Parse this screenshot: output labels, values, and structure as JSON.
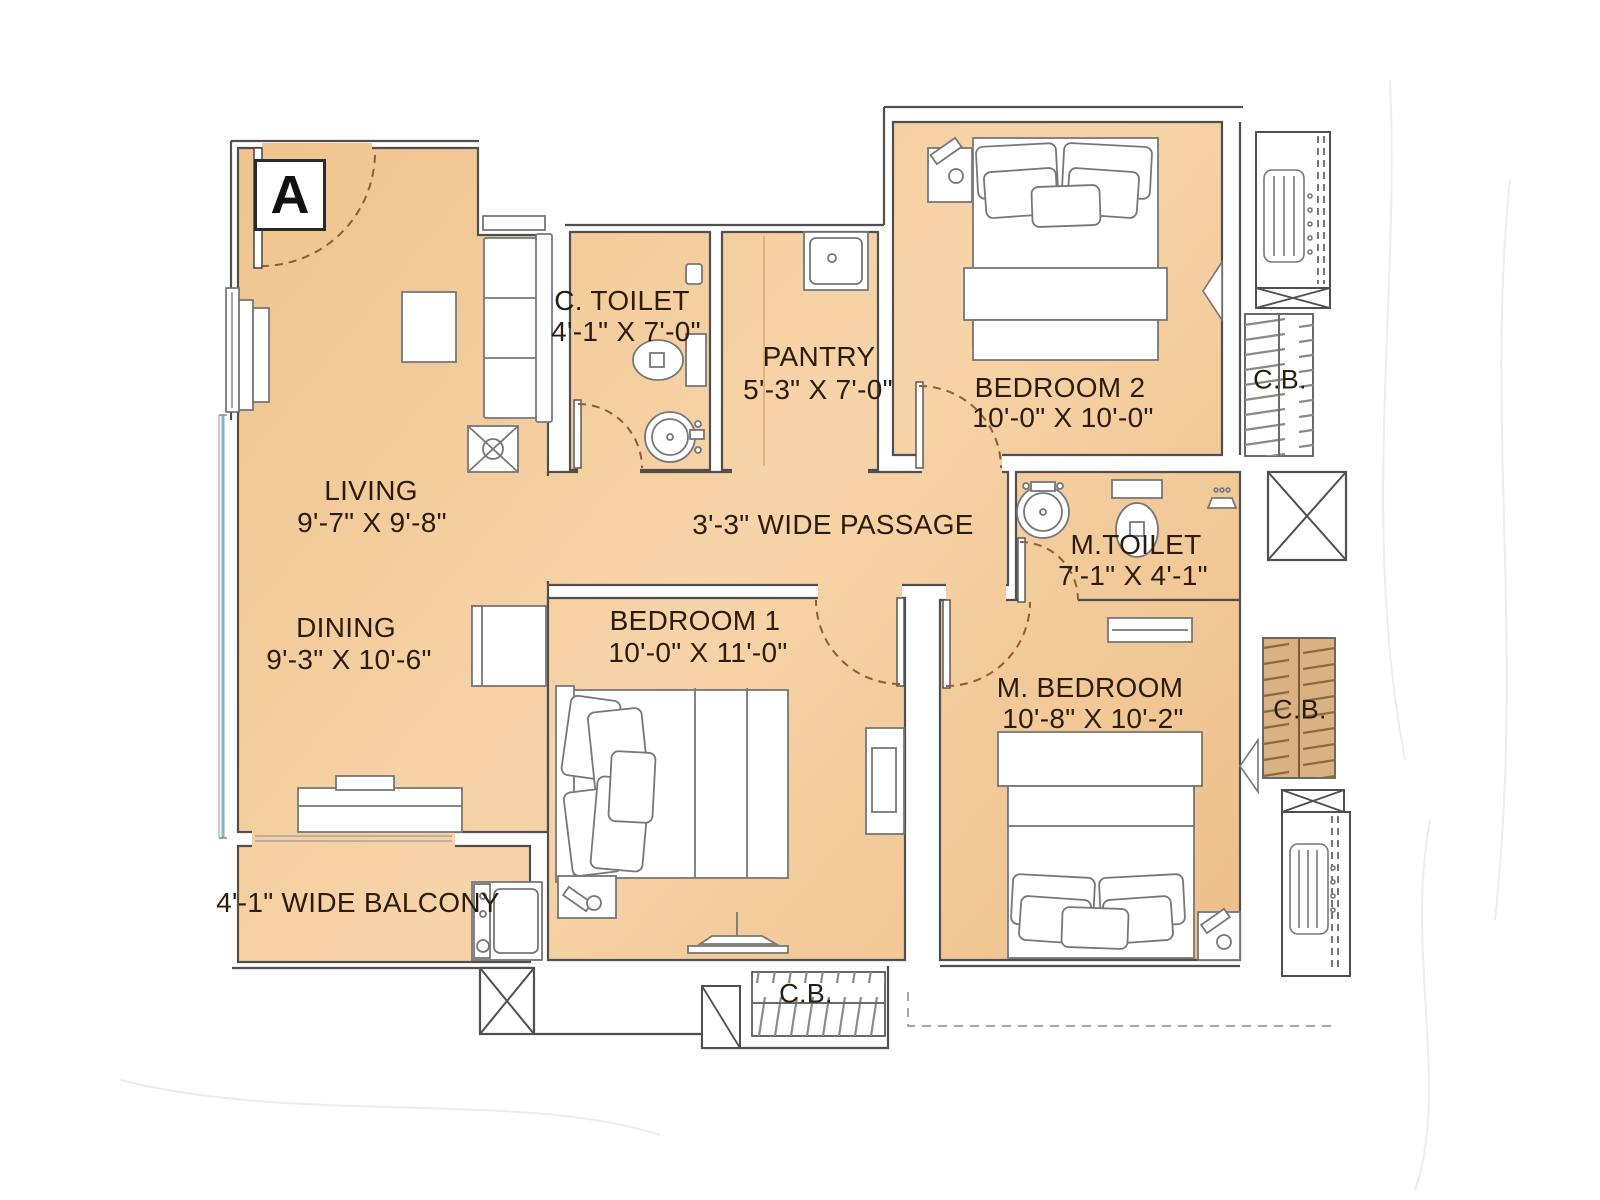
{
  "unit_label": "A",
  "rooms": {
    "living": {
      "name": "LIVING",
      "dims": "9'-7\" X 9'-8\""
    },
    "dining": {
      "name": "DINING",
      "dims": "9'-3\" X 10'-6\""
    },
    "c_toilet": {
      "name": "C. TOILET",
      "dims": "4'-1\" X 7'-0\""
    },
    "pantry": {
      "name": "PANTRY",
      "dims": "5'-3\" X 7'-0\""
    },
    "bedroom2": {
      "name": "BEDROOM 2",
      "dims": "10'-0\" X 10'-0\""
    },
    "passage": {
      "name": "3'-3\" WIDE PASSAGE"
    },
    "m_toilet": {
      "name": "M.TOILET",
      "dims": "7'-1\" X 4'-1\""
    },
    "bedroom1": {
      "name": "BEDROOM 1",
      "dims": "10'-0\" X 11'-0\""
    },
    "m_bedroom": {
      "name": "M. BEDROOM",
      "dims": "10'-8\" X 10'-2\""
    },
    "balcony": {
      "name": "4'-1\" WIDE BALCONY"
    }
  },
  "cupboards": {
    "top_right": "C.B.",
    "mid_right": "C.B.",
    "bottom": "C.B."
  },
  "colors": {
    "floor": "#f4cc9b",
    "floor_edge": "#e9bb85",
    "wall_line": "#4f4f4f",
    "text": "#2b1c0e",
    "door_arc": "#935a36",
    "glass": "#7fb7c9",
    "cb_fill": "#d9b183"
  }
}
